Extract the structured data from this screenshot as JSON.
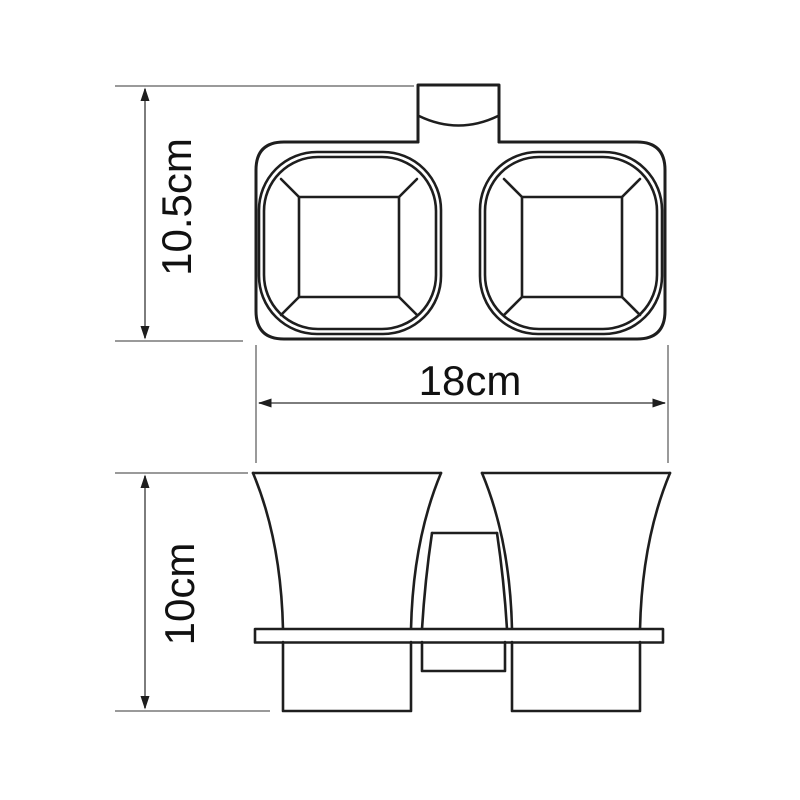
{
  "drawing": {
    "kind": "technical-dimension-drawing",
    "subject": "wall-mounted double tumbler holder, top view and front view",
    "background": "#ffffff"
  },
  "dimensions": {
    "top_view_height": {
      "label": "10.5cm",
      "value_cm": 10.5,
      "orientation": "vertical"
    },
    "overall_width": {
      "label": "18cm",
      "value_cm": 18,
      "orientation": "horizontal"
    },
    "front_view_height": {
      "label": "10cm",
      "value_cm": 10,
      "orientation": "vertical"
    }
  },
  "colors": {
    "outline": "#1e1e1e",
    "dimension_line": "#7d7d7d",
    "extension_line": "#9a9a9a",
    "text": "#111111",
    "background": "#ffffff"
  }
}
